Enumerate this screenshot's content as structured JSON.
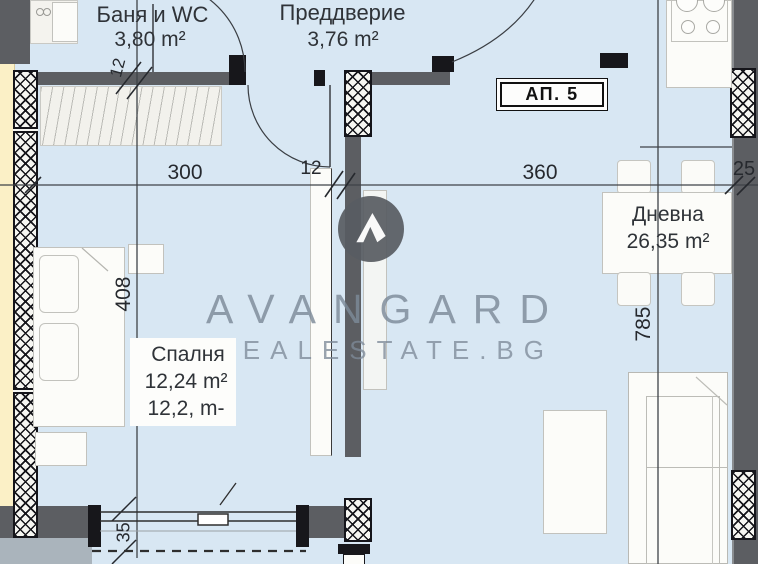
{
  "badge": {
    "label": "АП. 5"
  },
  "rooms": {
    "bathroom": {
      "name": "Баня и WC",
      "area": "3,80 m²"
    },
    "hallway": {
      "name": "Преддверие",
      "area": "3,76 m²"
    },
    "bedroom": {
      "name": "Спалня",
      "area": "12,24 m²",
      "area_overlay": "12,2, m-"
    },
    "living": {
      "name": "Дневна",
      "area": "26,35 m²"
    }
  },
  "dimensions": {
    "bedroom_width": "300",
    "mid_wall": "12",
    "living_width": "360",
    "right_wall": "25",
    "bedroom_height": "408",
    "living_height": "785",
    "top_wall": "12",
    "window": "35"
  },
  "watermark": {
    "brand": "AVANGARD",
    "site": "REALESTATE.BG"
  },
  "colors": {
    "floor": "#d8e7f3",
    "wall": "#5c5e62",
    "outer_insulation_strip": "#fbf0c6",
    "watermark_text": "#7d8a98",
    "line": "#3e4247"
  }
}
